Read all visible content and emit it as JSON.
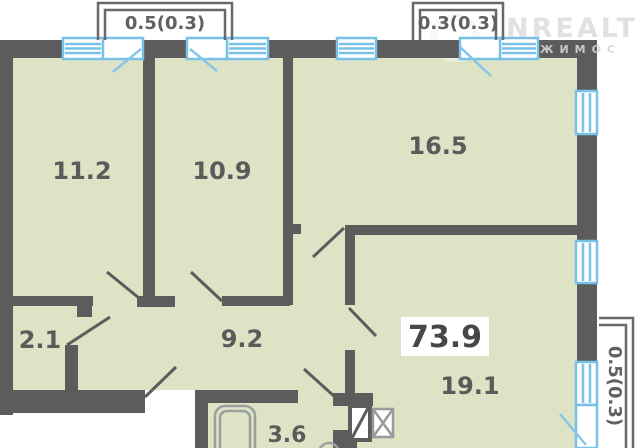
{
  "floorplan": {
    "total_area_label": "73.9",
    "rooms": [
      {
        "id": "bedroom-1",
        "area": "11.2"
      },
      {
        "id": "bedroom-2",
        "area": "10.9"
      },
      {
        "id": "living-room",
        "area": "16.5"
      },
      {
        "id": "storage",
        "area": "2.1"
      },
      {
        "id": "hallway",
        "area": "9.2"
      },
      {
        "id": "kitchen-room",
        "area": "19.1"
      },
      {
        "id": "bathroom",
        "area": "3.6"
      }
    ],
    "balconies": [
      {
        "id": "balcony-top-left",
        "label": "0.5(0.3)"
      },
      {
        "id": "balcony-top-right",
        "label": "0.3(0.3)"
      },
      {
        "id": "balcony-right",
        "label": "0.5(0.3)"
      }
    ],
    "watermark": {
      "primary": "NREALT",
      "secondary": "ЖИМОС"
    },
    "colors": {
      "wall": "#5c5c5c",
      "floor": "#dde3c4",
      "window": "#79c1e8",
      "window_fill": "#ffffff",
      "fixture": "#9aa0a0",
      "balcony_outline": "#696969",
      "label_text": "#5b5b5b"
    }
  }
}
